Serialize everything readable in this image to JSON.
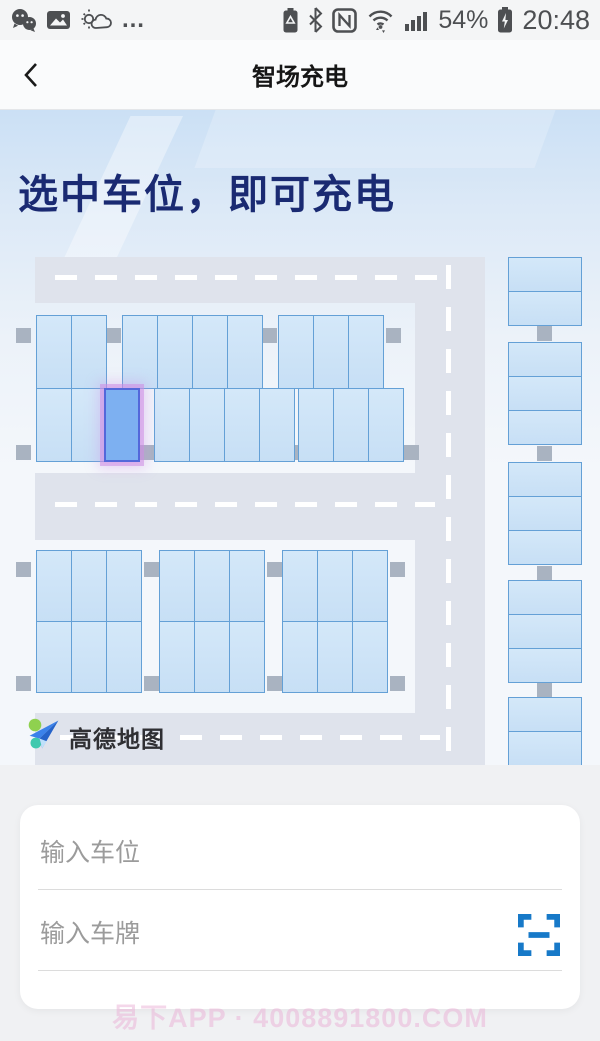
{
  "status_bar": {
    "time": "20:48",
    "battery_percent": "54%",
    "left_icons": [
      "wechat-icon",
      "gallery-icon",
      "weather-icon",
      "more-icon"
    ],
    "right_icons": [
      "battery-saver-icon",
      "bluetooth-icon",
      "nfc-icon",
      "wifi-icon",
      "signal-icon",
      "battery-charging-icon"
    ],
    "more_label": "…"
  },
  "nav": {
    "title": "智场充电"
  },
  "hero": {
    "headline": "选中车位，即可充电"
  },
  "map": {
    "attribution": "高德地图",
    "colors": {
      "road": "#dfe3ec",
      "spot_fill": "#cde3f7",
      "spot_border": "#64a0d6",
      "selected_fill": "#7db0f1",
      "selected_border": "#5368da",
      "selected_glow": "rgba(206,140,228,0.55)",
      "pillar": "#a9b3c1",
      "headline_color": "#1a2a72"
    },
    "spec": {
      "spot_width": 35,
      "roads": [
        {
          "x": 35,
          "y": 147,
          "w": 450,
          "h": 46
        },
        {
          "x": 415,
          "y": 147,
          "w": 70,
          "h": 508
        },
        {
          "x": 35,
          "y": 363,
          "w": 420,
          "h": 67
        },
        {
          "x": 35,
          "y": 603,
          "w": 420,
          "h": 52
        }
      ],
      "dashes": [
        {
          "type": "h",
          "x": 55,
          "y": 165,
          "len": 400
        },
        {
          "type": "h",
          "x": 55,
          "y": 392,
          "len": 380
        },
        {
          "type": "h",
          "x": 60,
          "y": 625,
          "len": 380
        },
        {
          "type": "v",
          "x": 446,
          "y": 155,
          "len": 495
        }
      ],
      "blocks": [
        {
          "row_height": 74,
          "rows": [
            {
              "y": 205,
              "groups": [
                {
                  "x": 36,
                  "count": 2
                },
                {
                  "x": 122,
                  "count": 4
                },
                {
                  "x": 278,
                  "count": 3
                }
              ]
            },
            {
              "y": 278,
              "groups": [
                {
                  "x": 36,
                  "count": 2
                },
                {
                  "x": 104,
                  "count": 1,
                  "selected": true
                },
                {
                  "x": 154,
                  "count": 4
                },
                {
                  "x": 298,
                  "count": 3
                }
              ]
            }
          ]
        },
        {
          "row_height": 72,
          "rows": [
            {
              "y": 440,
              "groups": [
                {
                  "x": 36,
                  "count": 3
                },
                {
                  "x": 159,
                  "count": 3
                },
                {
                  "x": 282,
                  "count": 3
                }
              ]
            },
            {
              "y": 511,
              "groups": [
                {
                  "x": 36,
                  "count": 3
                },
                {
                  "x": 159,
                  "count": 3
                },
                {
                  "x": 282,
                  "count": 3
                }
              ]
            }
          ]
        }
      ],
      "right_column": {
        "x": 508,
        "width": 74,
        "spot_height": 34,
        "groups": [
          {
            "y": 147,
            "count": 2
          },
          {
            "y": 232,
            "count": 3
          },
          {
            "y": 352,
            "count": 3
          },
          {
            "y": 470,
            "count": 3
          },
          {
            "y": 587,
            "count": 2
          }
        ]
      },
      "pillars": [
        {
          "x": 16,
          "y": 218
        },
        {
          "x": 106,
          "y": 218
        },
        {
          "x": 262,
          "y": 218
        },
        {
          "x": 386,
          "y": 218
        },
        {
          "x": 16,
          "y": 335
        },
        {
          "x": 139,
          "y": 335
        },
        {
          "x": 294,
          "y": 335
        },
        {
          "x": 404,
          "y": 335
        },
        {
          "x": 16,
          "y": 452
        },
        {
          "x": 144,
          "y": 452
        },
        {
          "x": 267,
          "y": 452
        },
        {
          "x": 390,
          "y": 452
        },
        {
          "x": 16,
          "y": 566
        },
        {
          "x": 144,
          "y": 566
        },
        {
          "x": 267,
          "y": 566
        },
        {
          "x": 390,
          "y": 566
        },
        {
          "x": 537,
          "y": 216
        },
        {
          "x": 537,
          "y": 336
        },
        {
          "x": 537,
          "y": 456
        },
        {
          "x": 537,
          "y": 573
        }
      ]
    }
  },
  "form": {
    "spot_placeholder": "输入车位",
    "plate_placeholder": "输入车牌"
  },
  "watermark": "易下APP · 4008891800.COM"
}
